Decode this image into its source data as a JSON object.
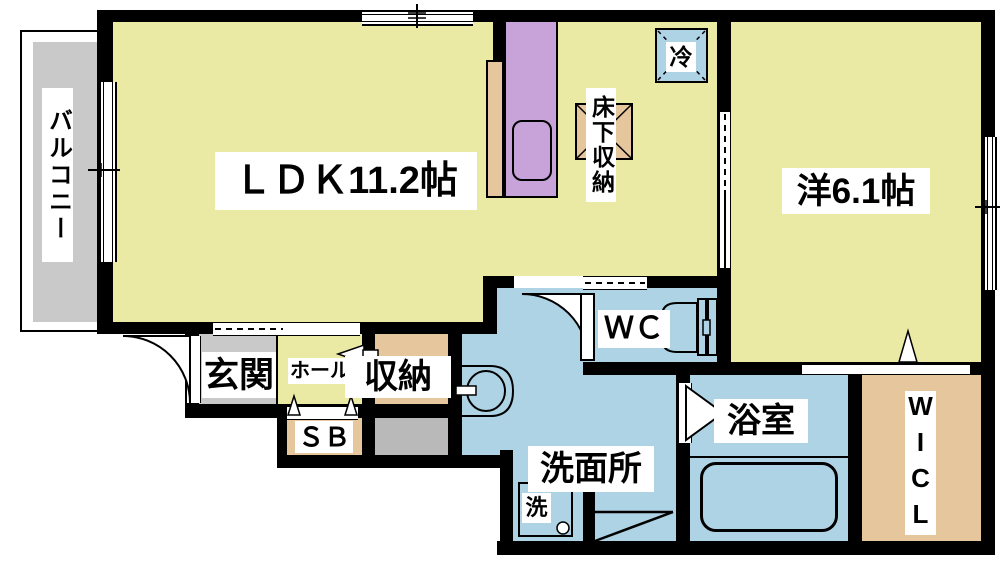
{
  "floorplan": {
    "type": "apartment-floor-plan",
    "rooms": {
      "balcony": {
        "label": "バルコニー"
      },
      "ldk": {
        "label": "ＬＤＫ11.2帖"
      },
      "western_room": {
        "label": "洋6.1帖"
      },
      "entrance": {
        "label": "玄関"
      },
      "hall": {
        "label": "ホール"
      },
      "storage": {
        "label": "収納"
      },
      "shoe_box": {
        "label": "ＳＢ"
      },
      "washroom": {
        "label": "洗面所"
      },
      "toilet_room": {
        "label": "ＷＣ"
      },
      "bathroom": {
        "label": "浴室"
      },
      "walk_in_closet": {
        "label": "WICL"
      }
    },
    "fixtures": {
      "refrigerator_space": {
        "label": "冷"
      },
      "underfloor_storage": {
        "label": "床下収納"
      },
      "washing_machine": {
        "label": "洗"
      }
    },
    "colors": {
      "room_yellow": "#eaeaa4",
      "water_blue": "#aed3e4",
      "closet_tan": "#e6c79d",
      "kitchen_purple": "#c7a3da",
      "balcony_gray": "#c9c9c9",
      "service_gray": "#b9b9b9",
      "wall_black": "#000000",
      "background": "#ffffff"
    }
  }
}
